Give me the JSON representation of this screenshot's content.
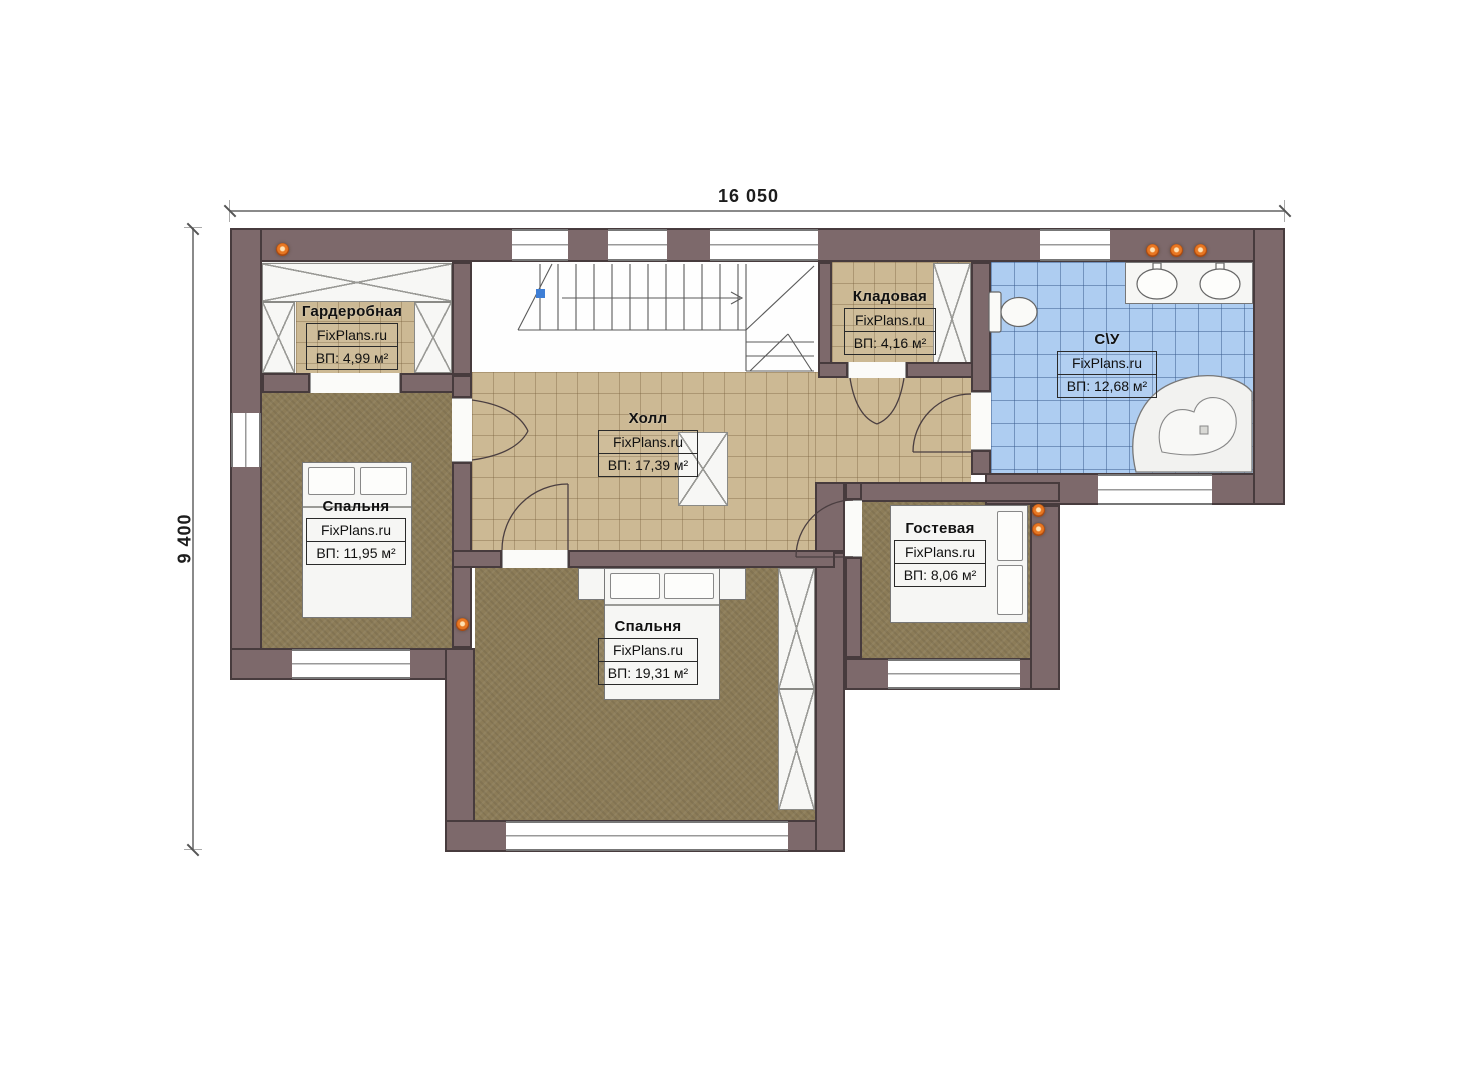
{
  "meta": {
    "drawing_type": "floor-plan",
    "brand_watermark": "FixPlans.ru"
  },
  "dimensions": {
    "width_label": "16 050",
    "height_label": "9 400"
  },
  "rooms": [
    {
      "id": "wardrobe",
      "name": "Гардеробная",
      "watermark": "FixPlans.ru",
      "area": "ВП: 4,99 м²"
    },
    {
      "id": "storage",
      "name": "Кладовая",
      "watermark": "FixPlans.ru",
      "area": "ВП: 4,16 м²"
    },
    {
      "id": "bathroom",
      "name": "С\\У",
      "watermark": "FixPlans.ru",
      "area": "ВП: 12,68 м²"
    },
    {
      "id": "hall",
      "name": "Холл",
      "watermark": "FixPlans.ru",
      "area": "ВП: 17,39 м²"
    },
    {
      "id": "bedroom-1",
      "name": "Спальня",
      "watermark": "FixPlans.ru",
      "area": "ВП: 11,95 м²"
    },
    {
      "id": "bedroom-2",
      "name": "Спальня",
      "watermark": "FixPlans.ru",
      "area": "ВП: 19,31 м²"
    },
    {
      "id": "guest",
      "name": "Гостевая",
      "watermark": "FixPlans.ru",
      "area": "ВП: 8,06 м²"
    }
  ],
  "colors": {
    "wall": "#7d696b",
    "wall_outline": "#473b3d",
    "tile_tan": "#ccb994",
    "tile_blue": "#aecdf1",
    "carpet": "#8c7c58",
    "spotlight": "#e87722",
    "stair_marker_blue": "#3f7fd6"
  }
}
